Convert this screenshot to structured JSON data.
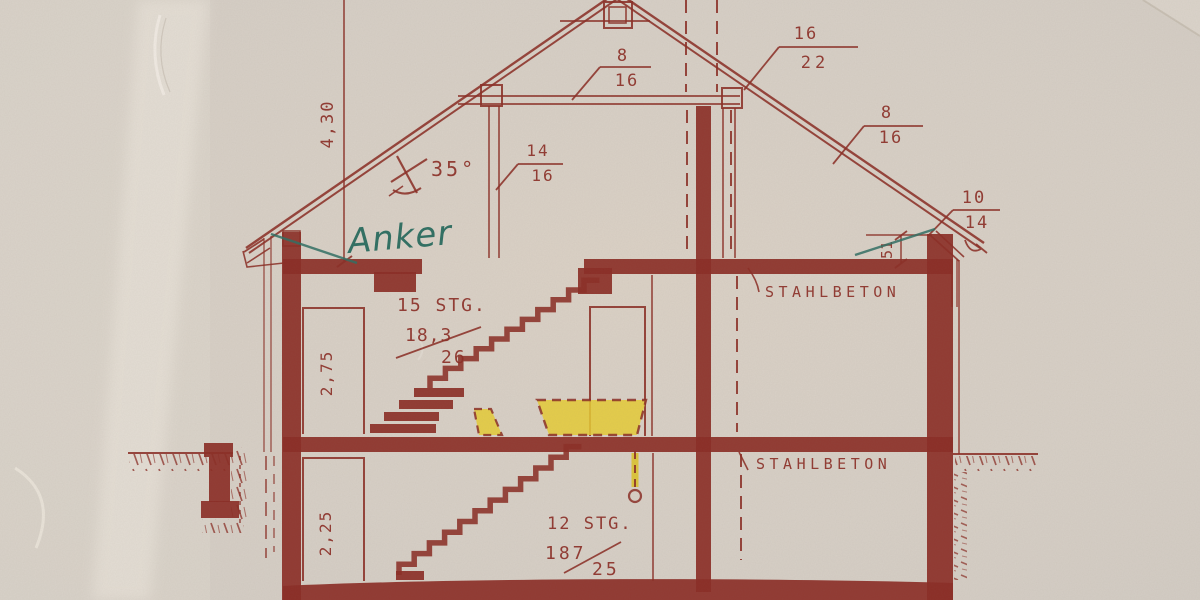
{
  "labels": {
    "roof_height": "4,30",
    "roof_angle": "35°",
    "knee_wall_height": "51",
    "anker_note": "Anker",
    "stahlbeton_upper": "STAHLBETON",
    "stahlbeton_lower": "STAHLBETON",
    "room_height_upper": "2,75",
    "room_height_lower": "2,25"
  },
  "timber_sections": {
    "ridge_beam": {
      "num": "8",
      "den": "16"
    },
    "purlin_right": {
      "num": "16",
      "den": "22"
    },
    "rafter_right": {
      "num": "8",
      "den": "16"
    },
    "eave_rafter_right": {
      "num": "10",
      "den": "14"
    },
    "attic_post": {
      "num": "14",
      "den": "16"
    }
  },
  "stairs": {
    "upper": {
      "label": "15 STG.",
      "rise": "18,3",
      "run": "26"
    },
    "lower": {
      "label": "12 STG.",
      "rise": "187",
      "run": "25"
    }
  },
  "colors": {
    "ink": "#8b2d25",
    "paper": "#d7d0c7",
    "highlight": "#e6cc35",
    "note": "#2f6f63"
  }
}
